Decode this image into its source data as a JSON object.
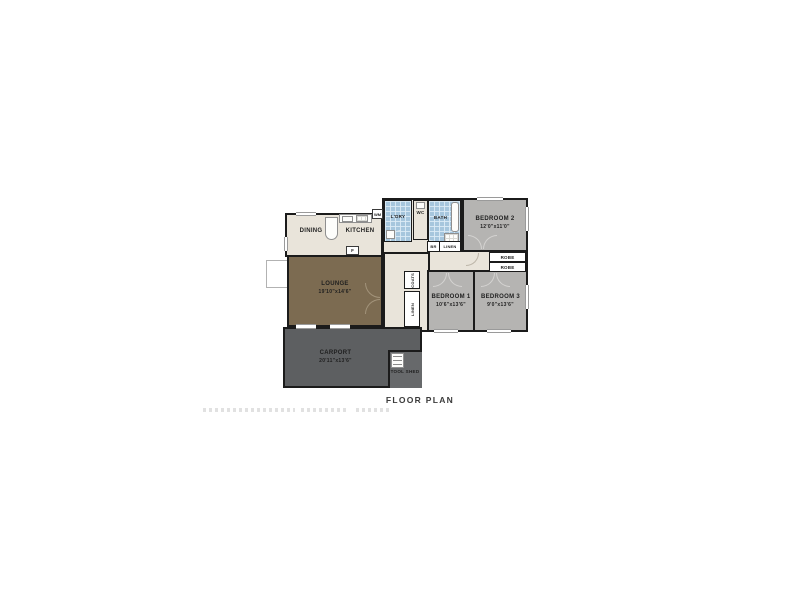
{
  "page": {
    "caption": "FLOOR PLAN"
  },
  "palette": {
    "wall": "#1b1b1b",
    "floor": "#e9e4da",
    "wet_area_blue": "#a6c6dd",
    "bedroom_gray": "#b5b4b2",
    "lounge_brown": "#7c6b51",
    "carport_gray": "#5d5f61",
    "label_text": "#1f1f1f"
  },
  "rooms": {
    "dining": {
      "label": "DINING"
    },
    "kitchen": {
      "label": "KITCHEN"
    },
    "laundry": {
      "label": "L'DRY"
    },
    "wc": {
      "label": "WC"
    },
    "bath": {
      "label": "BATH"
    },
    "bedroom2": {
      "label": "BEDROOM 2",
      "dims": "12'0\"x11'0\""
    },
    "lounge": {
      "label": "LOUNGE",
      "dims": "19'10\"x14'6\""
    },
    "bedroom1": {
      "label": "BEDROOM 1",
      "dims": "10'6\"x13'6\""
    },
    "bedroom3": {
      "label": "BEDROOM 3",
      "dims": "9'0\"x13'6\""
    },
    "carport": {
      "label": "CARPORT",
      "dims": "20'11\"x13'6\""
    },
    "toolshed": {
      "label": "TOOL SHED"
    }
  },
  "closets": {
    "robe_top": "ROBE",
    "robe_bottom": "ROBE",
    "linen_bath": "LINEN",
    "br": "BR",
    "coats": "COATS",
    "linen_hall": "LINEN"
  },
  "appliances": {
    "fridge": "F",
    "washer": "WM"
  }
}
